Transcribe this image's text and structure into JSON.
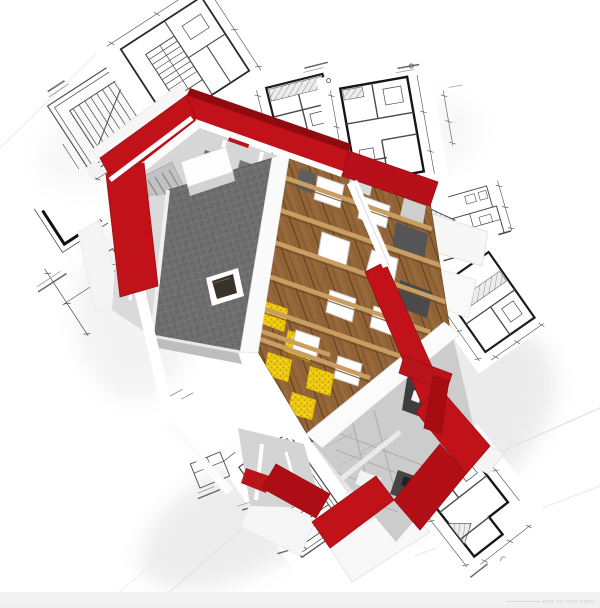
{
  "scene": {
    "type": "3d-architectural-render",
    "description": "3D cutaway model of a house under construction lying on scattered architectural blueprint sheets",
    "background_color": "#ffffff",
    "bottom_strip_color": "#f0f0f0"
  },
  "palette": {
    "wall_red": "#c1121a",
    "wall_red_dark": "#8e0b10",
    "roof_slate_gray": "#6f6f6f",
    "wood_floor": "#936538",
    "wood_beam": "#c89e62",
    "insulation_yellow": "#eec90f",
    "interior_floor_gray": "#d2d2d2",
    "dark_room_gray": "#4a4a4a",
    "blueprint_line": "#4a4a4a",
    "blueprint_wall_black": "#1a1a1a",
    "paper_white": "#ffffff",
    "shadow_wash": "#dadada"
  },
  "house": {
    "parts": [
      "red exterior masonry walls (cutaway)",
      "slate roof panel with skylight window",
      "white dormer chimney block",
      "wooden attic floor with cross joists",
      "yellow mineral insulation patches",
      "white floor openings",
      "interior staircase",
      "kitchen with dark counter",
      "bathroom with dark floor and white fixtures",
      "white cut-wall tops and eave sheets"
    ]
  },
  "blueprint_sheets": [
    {
      "id": "stair-framing-plan",
      "area": "top-left"
    },
    {
      "id": "floor-plan-with-stair-detail",
      "area": "top-center"
    },
    {
      "id": "hatched-floor-plan",
      "area": "top-right-inner"
    },
    {
      "id": "large-floor-plan",
      "area": "top-right"
    },
    {
      "id": "building-section-elevation",
      "area": "right"
    },
    {
      "id": "floor-plan-right",
      "area": "right-middle"
    },
    {
      "id": "l-shaped-floor-plan",
      "area": "bottom-right"
    },
    {
      "id": "stair-plan",
      "area": "bottom-center"
    },
    {
      "id": "detail-diamond",
      "area": "bottom-left-center"
    },
    {
      "id": "dimension-fragments",
      "area": "left-edge"
    }
  ],
  "watermark": {
    "text": "nnn nn nnn nnnn",
    "legible": false,
    "color": "#c9c9c9"
  }
}
